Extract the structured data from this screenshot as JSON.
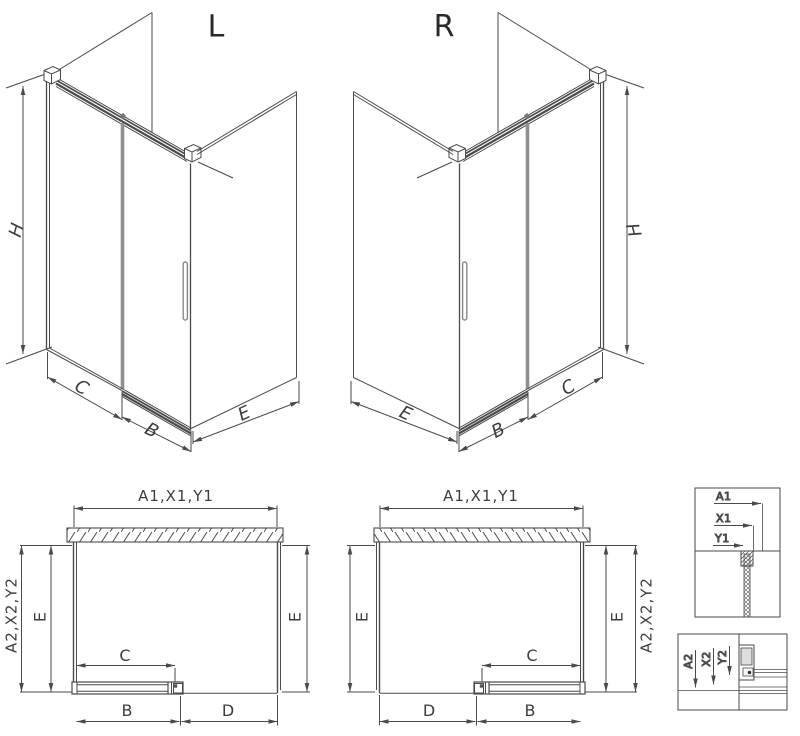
{
  "diagram_title": "Shower enclosure configuration drawing",
  "colors": {
    "line": "#4a4a4a",
    "profile_gray": "#8f8f8f",
    "background": "#ffffff"
  },
  "iso_views": {
    "left": {
      "title": "L",
      "height_dim": "H",
      "fixed_panel_dim": "C",
      "door_dim": "B",
      "side_panel_dim": "E"
    },
    "right": {
      "title": "R",
      "height_dim": "H",
      "fixed_panel_dim": "C",
      "door_dim": "B",
      "side_panel_dim": "E"
    }
  },
  "plan_views": {
    "left": {
      "width_dim": "A1,X1,Y1",
      "depth_dim": "A2,X2,Y2",
      "side_left": "E",
      "side_right": "E",
      "door_clear": "C",
      "door_width": "B",
      "opening": "D"
    },
    "right": {
      "width_dim": "A1,X1,Y1",
      "depth_dim": "A2,X2,Y2",
      "side_left": "E",
      "side_right": "E",
      "door_clear": "C",
      "door_width": "B",
      "opening": "D"
    }
  },
  "details": {
    "wall_profile": {
      "labels": [
        "A1",
        "X1",
        "Y1"
      ]
    },
    "bottom_rail": {
      "labels": [
        "A2",
        "X2",
        "Y2"
      ]
    }
  }
}
